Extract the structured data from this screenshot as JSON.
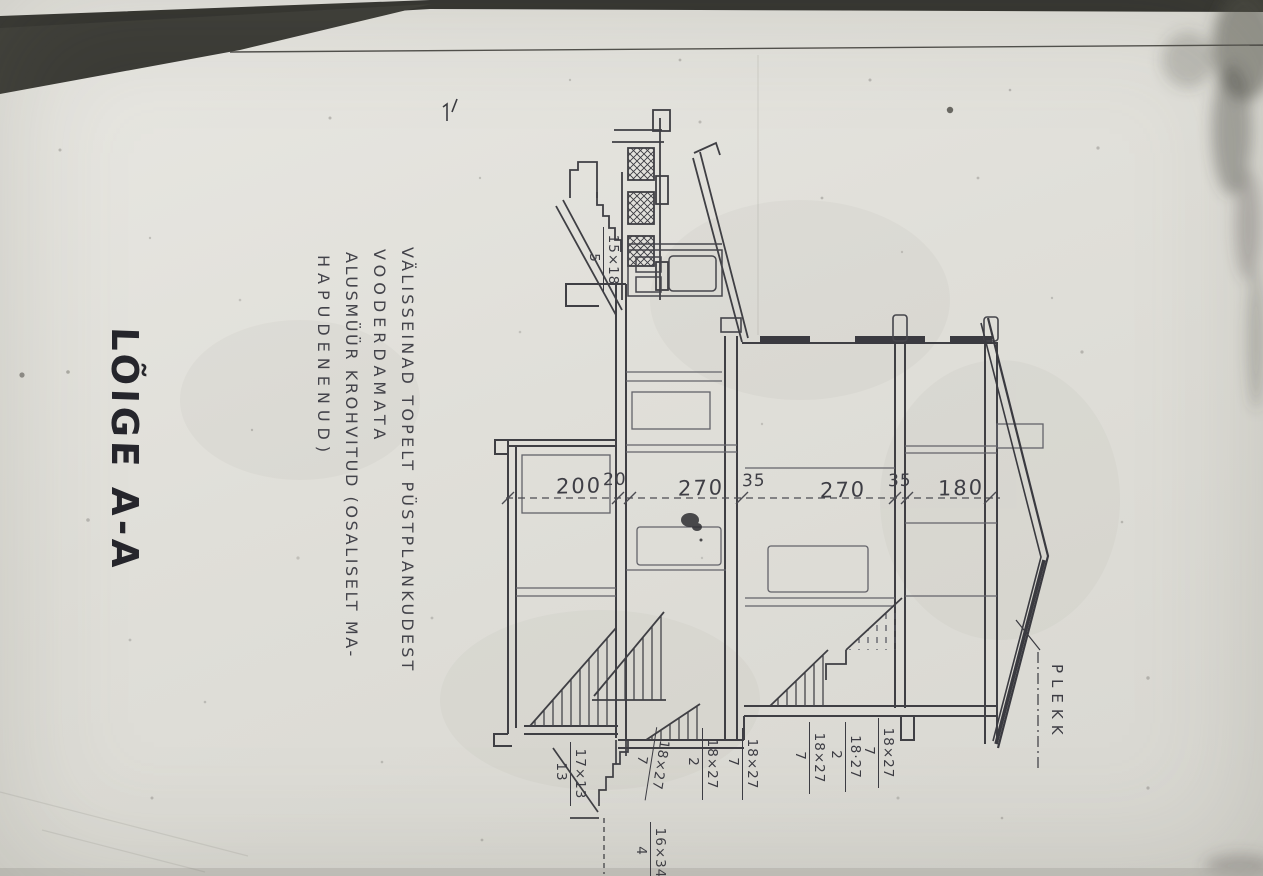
{
  "photo": {
    "description": "Photograph of a hand-drawn building section drawing, rotated 90 degrees on the paper",
    "paper_color": "#e3e2dc",
    "shadow_band_color": "#34332f",
    "ink_color": "#3b3b41"
  },
  "title": {
    "text": "LÕIGE A-A"
  },
  "notes": {
    "lines": [
      "VÄLISSEINAD TOPELT PÜSTPLANKUDEST",
      "VOODERDAMATA",
      "ALUSMÜÜR KROHVITUD (OSALISELT MA-",
      "HAPUDENENUD)"
    ]
  },
  "dimensions": {
    "values": [
      "200",
      "20",
      "270",
      "35",
      "270",
      "35",
      "180"
    ]
  },
  "fractions": [
    {
      "num": "15×18",
      "den": "5"
    },
    {
      "num": "17×13",
      "den": "13"
    },
    {
      "num": "18×27",
      "den": "7"
    },
    {
      "num": "18×27",
      "den": "2"
    },
    {
      "num": "18×27",
      "den": "7"
    },
    {
      "num": "18×27",
      "den": "7"
    },
    {
      "num": "18·27",
      "den": "2"
    },
    {
      "num": "18×27",
      "den": "7"
    },
    {
      "num": "16×34",
      "den": "4"
    }
  ],
  "labels": {
    "roof_material": "PLEKK"
  }
}
